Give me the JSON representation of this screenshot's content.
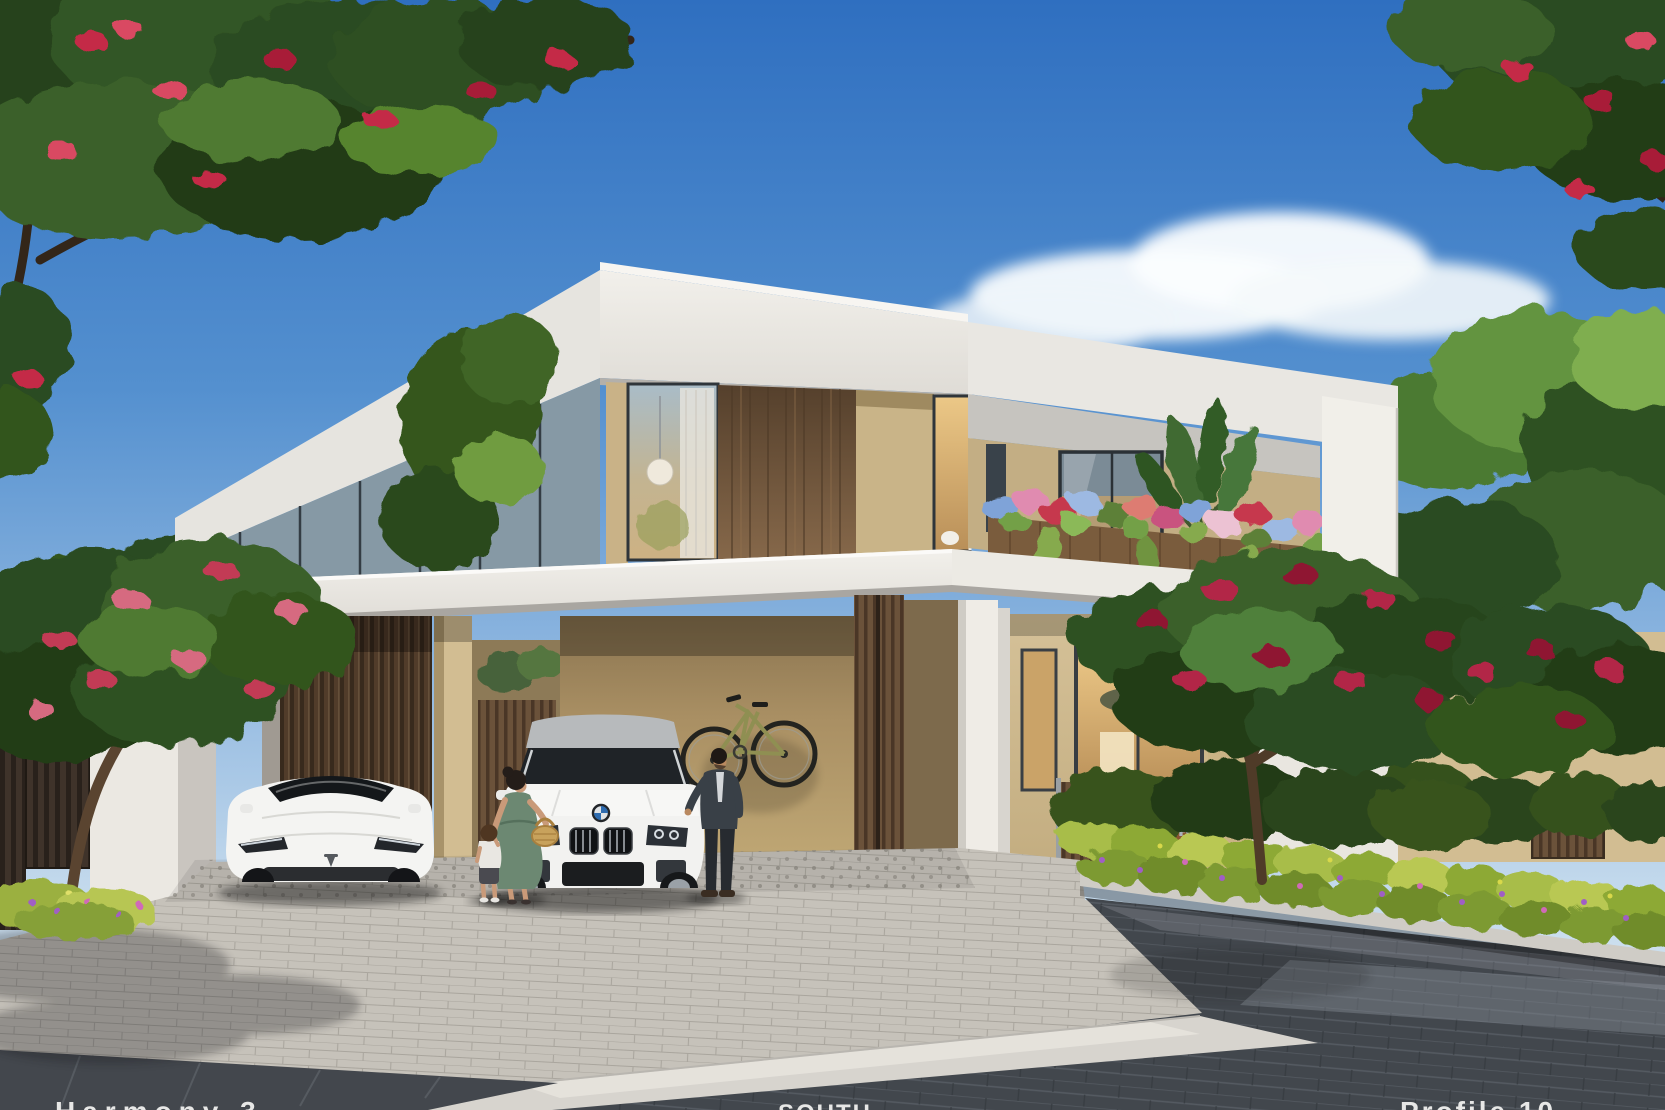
{
  "scene": {
    "type": "architectural-exterior-render",
    "subject": "Modern two-storey villa with carport, two white cars, family figures and landscaped garden"
  },
  "house_number": "43",
  "captions": {
    "left": "Harmony 3",
    "center": "SOUTH",
    "right": "Profile 10"
  },
  "vehicles": [
    {
      "name": "tesla-sedan",
      "color": "white"
    },
    {
      "name": "bmw-suv",
      "color": "white"
    }
  ],
  "people": [
    {
      "name": "woman-with-basket"
    },
    {
      "name": "toddler"
    },
    {
      "name": "man-in-suit"
    }
  ],
  "palette": {
    "sky_top": "#2f6fc0",
    "sky_horizon": "#e2edf4",
    "cloud": "#f8fbfd",
    "roof_white": "#eceae5",
    "canopy_white": "#f4f2ed",
    "wall_beige": "#cdb88d",
    "wall_tan_shade": "#a98f63",
    "wood_panel": "#6e5138",
    "garage_slats": "#463528",
    "corten_panel": "#8a5632",
    "house_number_text": "#aab2ba",
    "glass_cool": "#a9bcc8",
    "glass_warm": "#ecc887",
    "foliage_dark": "#223d19",
    "foliage_mid": "#2f5122",
    "foliage_light": "#4f7a30",
    "flower_red": "#c42a46",
    "flower_pink": "#d66a80",
    "flower_blue": "#7fa3d8",
    "hedge_green": "#8fae3e",
    "hedge_purple": "#a05ec6",
    "paver_light": "#c6c2ba",
    "road_dark": "#42474d",
    "sidewalk": "#d7d4ce",
    "car_body": "#f3f3f1",
    "dress_green": "#6c8872",
    "suit_dark": "#394047"
  }
}
